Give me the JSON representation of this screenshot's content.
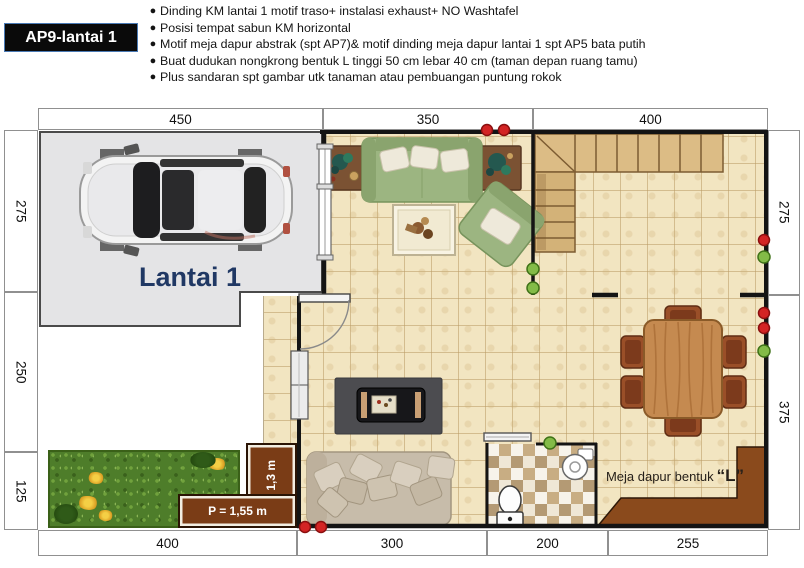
{
  "header": {
    "title": "AP9-lantai 1",
    "bullets": [
      "Dinding KM lantai 1 motif traso+ instalasi  exhaust+ NO Washtafel",
      "Posisi tempat sabun KM horizontal",
      "Motif meja dapur abstrak (spt AP7)& motif dinding meja dapur lantai 1 spt AP5 bata putih",
      "Buat dudukan nongkrong bentuk L tinggi 50 cm lebar 40 cm (taman depan ruang tamu)",
      "Plus sandaran spt gambar utk tanaman atau pembuangan puntung rokok"
    ]
  },
  "plan": {
    "floor_label": "Lantai 1",
    "kitchen_label": "Meja dapur bentuk",
    "kitchen_label_quote": "“L”",
    "bench_horizontal_label": "P = 1,55 m",
    "bench_vertical_label": "P = 1,3 m",
    "dimensions": {
      "top": [
        "450",
        "350",
        "400"
      ],
      "left": [
        "275",
        "250",
        "125"
      ],
      "right": [
        "275",
        "375"
      ],
      "bottom": [
        "400",
        "300",
        "200",
        "255"
      ]
    },
    "colors": {
      "floor_label_text": "#203864",
      "wall": "#141414",
      "tile_floor": "#f2e5c1",
      "counter_brown": "#8a4a1c",
      "bench_brown": "#7a3c16",
      "sofa_green": "#9cb581",
      "marker_red": "#d32424",
      "marker_green": "#83bb47"
    }
  }
}
